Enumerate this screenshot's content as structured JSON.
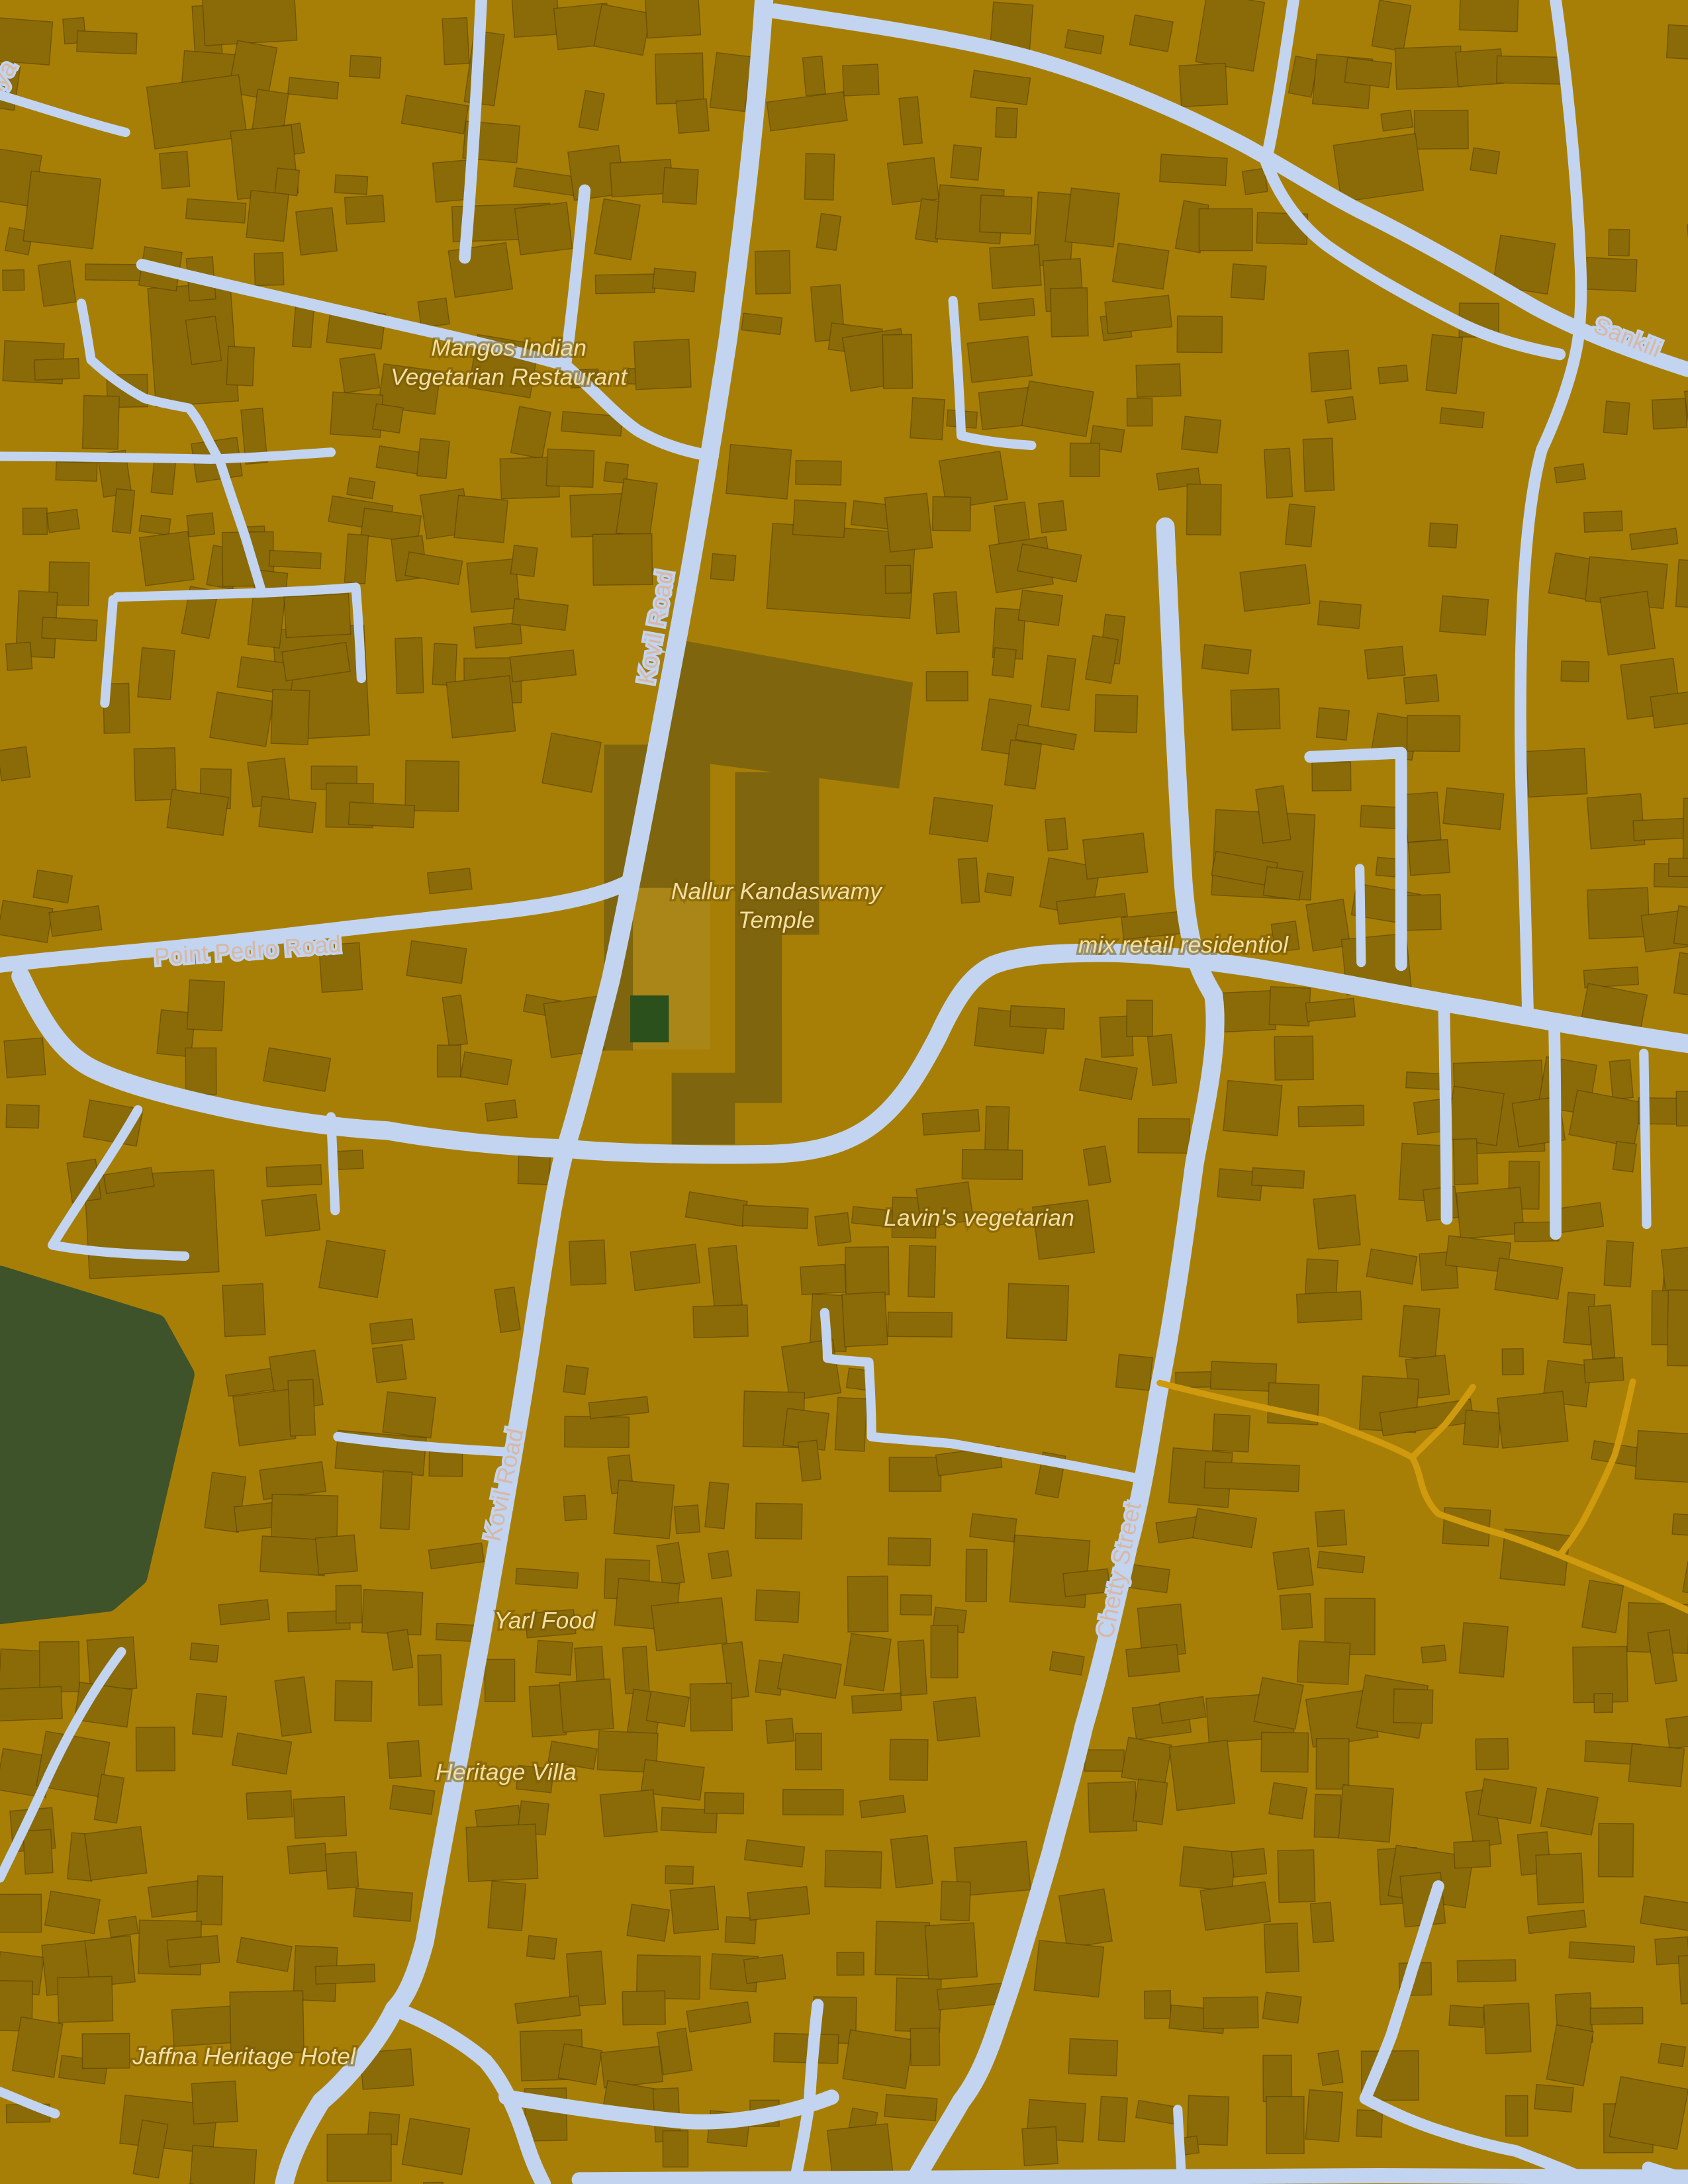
{
  "map": {
    "colors": {
      "land": "#a87f06",
      "building": "#8a6b08",
      "building_outline": "rgba(70,52,2,0.45)",
      "temple_ground": "#7f650e",
      "courtyard": "#aa8618",
      "pond_green": "#3e5329",
      "park_green": "#2c501c",
      "road": "#c2d4ef",
      "road_unpaved": "#cf9a0d",
      "road_label_text": "#d8b8a4",
      "poi_label_text": "#f2dfa6"
    },
    "labels": {
      "mangos": {
        "line1": "Mangos Indian",
        "line2": "Vegetarian Restaurant"
      },
      "nallur": {
        "line1": "Nallur Kandaswamy",
        "line2": "Temple"
      },
      "lavins": {
        "text": "Lavin's vegetarian"
      },
      "mix_retail": {
        "text": "mix retail residentiol"
      },
      "yarl_food": {
        "text": "Yarl Food"
      },
      "heritage_villa": {
        "text": "Heritage Villa"
      },
      "jaffna_hotel": {
        "text": "Jaffna Heritage Hotel"
      },
      "point_pedro": {
        "text": "Point Pedro Road"
      },
      "kovil_upper": {
        "text": "Kovil Road"
      },
      "kovil_lower": {
        "text": "Kovil Road"
      },
      "chetty": {
        "text": "Chetty Street"
      },
      "sankili": {
        "text": "Sankili"
      },
      "corner_fragment": {
        "text": "niya"
      }
    }
  }
}
